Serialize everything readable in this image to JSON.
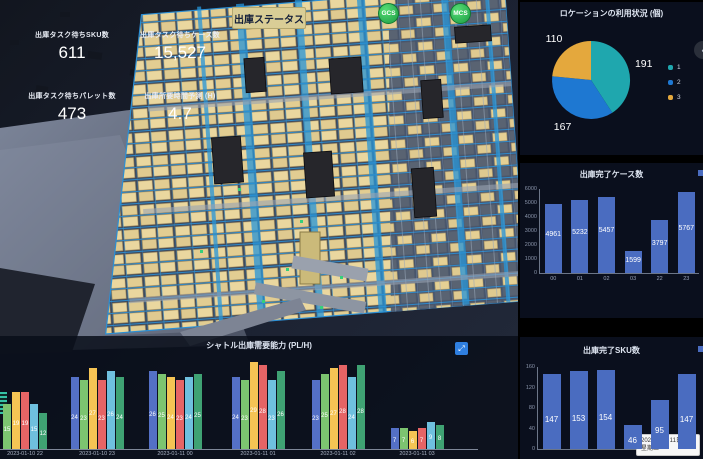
{
  "header": {
    "status_button": "出庫ステータス",
    "badges": [
      {
        "label": "GCS"
      },
      {
        "label": "MCS"
      }
    ]
  },
  "kpis": [
    {
      "label": "出庫タスク待ちSKU数",
      "value": "611"
    },
    {
      "label": "出庫タスク待ちケース数",
      "value": "15,527"
    },
    {
      "label": "出庫タスク待ちパレット数",
      "value": "473"
    },
    {
      "label": "出庫所要時間予測 (H)",
      "value": "4.7"
    }
  ],
  "chart_data": [
    {
      "type": "pie",
      "title": "ロケーションの利用状況 (個)",
      "legend_position": "right",
      "segments": [
        {
          "label": "1",
          "value": 191,
          "color": "#1fa7ae"
        },
        {
          "label": "2",
          "value": 167,
          "color": "#1e78d2"
        },
        {
          "label": "3",
          "value": 110,
          "color": "#e4a83d"
        }
      ]
    },
    {
      "type": "bar",
      "title": "出庫完了ケース数",
      "categories": [
        "00",
        "01",
        "02",
        "03",
        "22",
        "23"
      ],
      "values": [
        4961,
        5232,
        5457,
        1599,
        3797,
        5767
      ],
      "ylim": [
        0,
        6000
      ],
      "yticks": [
        0,
        1000,
        2000,
        3000,
        4000,
        5000,
        6000
      ],
      "bar_color": "#4a6cc0"
    },
    {
      "type": "bar",
      "title": "出庫完了SKU数",
      "categories": [],
      "values": [
        147,
        153,
        154,
        46,
        95,
        147
      ],
      "ylim": [
        0,
        160
      ],
      "yticks": [
        0,
        40,
        80,
        120,
        160
      ],
      "bar_color": "#4a6cc0"
    },
    {
      "type": "bar",
      "title": "シャトル出庫需要能力 (PL/H)",
      "categories": [
        "2023-01-10 22",
        "2023-01-10 23",
        "2023-01-11 00",
        "2023-01-11 01",
        "2023-01-11 02",
        "2023-01-11 03"
      ],
      "ylim": [
        0,
        30
      ],
      "series": [
        {
          "name": "series-1",
          "color": "#5470c6",
          "values": [
            null,
            24,
            26,
            24,
            23,
            7
          ]
        },
        {
          "name": "series-2",
          "color": "#7cc470",
          "values": [
            15,
            23,
            25,
            23,
            25,
            7
          ]
        },
        {
          "name": "series-3",
          "color": "#f5c454",
          "values": [
            19,
            27,
            24,
            29,
            27,
            6
          ]
        },
        {
          "name": "series-4",
          "color": "#e66465",
          "values": [
            19,
            23,
            23,
            28,
            28,
            7
          ]
        },
        {
          "name": "series-5",
          "color": "#6fc0de",
          "values": [
            15,
            26,
            24,
            23,
            24,
            9
          ]
        },
        {
          "name": "series-6",
          "color": "#3fa273",
          "values": [
            12,
            24,
            25,
            26,
            28,
            8
          ]
        }
      ]
    }
  ],
  "tooltip": {
    "date": "2023年1月11日",
    "weekday": "星期三"
  }
}
